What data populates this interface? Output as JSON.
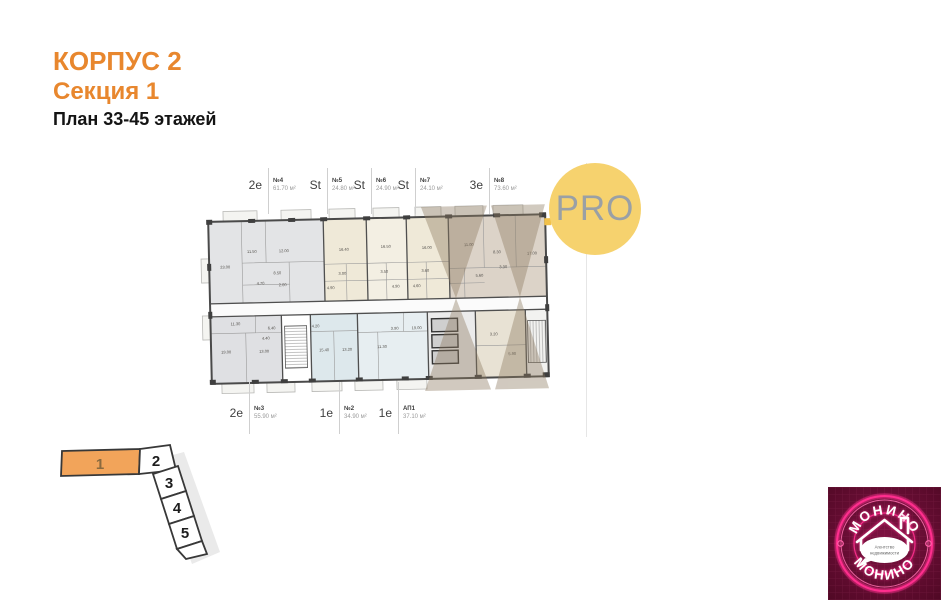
{
  "header": {
    "building": "КОРПУС 2",
    "section": "Секция 1",
    "plan": "План 33-45 этажей"
  },
  "badge": {
    "label": "PRO"
  },
  "floorplan": {
    "top_units": [
      {
        "type": "2е",
        "num": "№4",
        "area": "61.70 м²",
        "line_x": 268
      },
      {
        "type": "St",
        "num": "№5",
        "area": "24.80 м²",
        "line_x": 327
      },
      {
        "type": "St",
        "num": "№6",
        "area": "24.90 м²",
        "line_x": 371
      },
      {
        "type": "St",
        "num": "№7",
        "area": "24.10 м²",
        "line_x": 415
      },
      {
        "type": "3е",
        "num": "№8",
        "area": "73.60 м²",
        "line_x": 489
      }
    ],
    "bottom_units": [
      {
        "type": "2е",
        "num": "№3",
        "area": "55.90 м²",
        "line_x": 249
      },
      {
        "type": "1е",
        "num": "№2",
        "area": "34.90 м²",
        "line_x": 339
      },
      {
        "type": "1е",
        "num": "АП1",
        "area": "37.10 м²",
        "line_x": 398
      }
    ],
    "rooms": [
      {
        "x": 31,
        "y": 105,
        "v": "23.00"
      },
      {
        "x": 58,
        "y": 90,
        "v": "11.50"
      },
      {
        "x": 90,
        "y": 90,
        "v": "12.00"
      },
      {
        "x": 83,
        "y": 112,
        "v": "8.50"
      },
      {
        "x": 66,
        "y": 122,
        "v": "4.70"
      },
      {
        "x": 88,
        "y": 124,
        "v": "2.00"
      },
      {
        "x": 150,
        "y": 90,
        "v": "16.40"
      },
      {
        "x": 148,
        "y": 114,
        "v": "3.00"
      },
      {
        "x": 136,
        "y": 128,
        "v": "4.90"
      },
      {
        "x": 192,
        "y": 88,
        "v": "16.50"
      },
      {
        "x": 190,
        "y": 113,
        "v": "3.50"
      },
      {
        "x": 201,
        "y": 128,
        "v": "4.90"
      },
      {
        "x": 233,
        "y": 90,
        "v": "16.00"
      },
      {
        "x": 231,
        "y": 113,
        "v": "3.60"
      },
      {
        "x": 222,
        "y": 128,
        "v": "4.60"
      },
      {
        "x": 275,
        "y": 88,
        "v": "11.00"
      },
      {
        "x": 303,
        "y": 96,
        "v": "8.30"
      },
      {
        "x": 338,
        "y": 98,
        "v": "17.00"
      },
      {
        "x": 285,
        "y": 119,
        "v": "5.60"
      },
      {
        "x": 309,
        "y": 111,
        "v": "3.30"
      },
      {
        "x": 40,
        "y": 162,
        "v": "11.30"
      },
      {
        "x": 30,
        "y": 190,
        "v": "19.00"
      },
      {
        "x": 68,
        "y": 190,
        "v": "13.00"
      },
      {
        "x": 76,
        "y": 167,
        "v": "6.40"
      },
      {
        "x": 70,
        "y": 177,
        "v": "4.40"
      },
      {
        "x": 120,
        "y": 166,
        "v": "4.20"
      },
      {
        "x": 128,
        "y": 190,
        "v": "15.40"
      },
      {
        "x": 151,
        "y": 190,
        "v": "13.20"
      },
      {
        "x": 186,
        "y": 188,
        "v": "11.30"
      },
      {
        "x": 199,
        "y": 170,
        "v": "3.90"
      },
      {
        "x": 221,
        "y": 170,
        "v": "19.00"
      },
      {
        "x": 298,
        "y": 178,
        "v": "3.20"
      },
      {
        "x": 316,
        "y": 198,
        "v": "5.90"
      }
    ]
  },
  "section_key": {
    "items": [
      {
        "label": "1",
        "highlighted": true
      },
      {
        "label": "2",
        "highlighted": false
      },
      {
        "label": "3",
        "highlighted": false
      },
      {
        "label": "4",
        "highlighted": false
      },
      {
        "label": "5",
        "highlighted": false
      }
    ]
  },
  "logo": {
    "top_text": "МОНИНО",
    "bottom_text": "МОНИНО",
    "bubble_line1": "Агентство",
    "bubble_line2": "недвижимости"
  },
  "colors": {
    "accent_orange": "#e8872e",
    "pro_badge": "#f6d26e",
    "key_highlight": "#f2a45a",
    "logo_pink": "#ff2f8e",
    "logo_background": "#5e0a2e"
  }
}
